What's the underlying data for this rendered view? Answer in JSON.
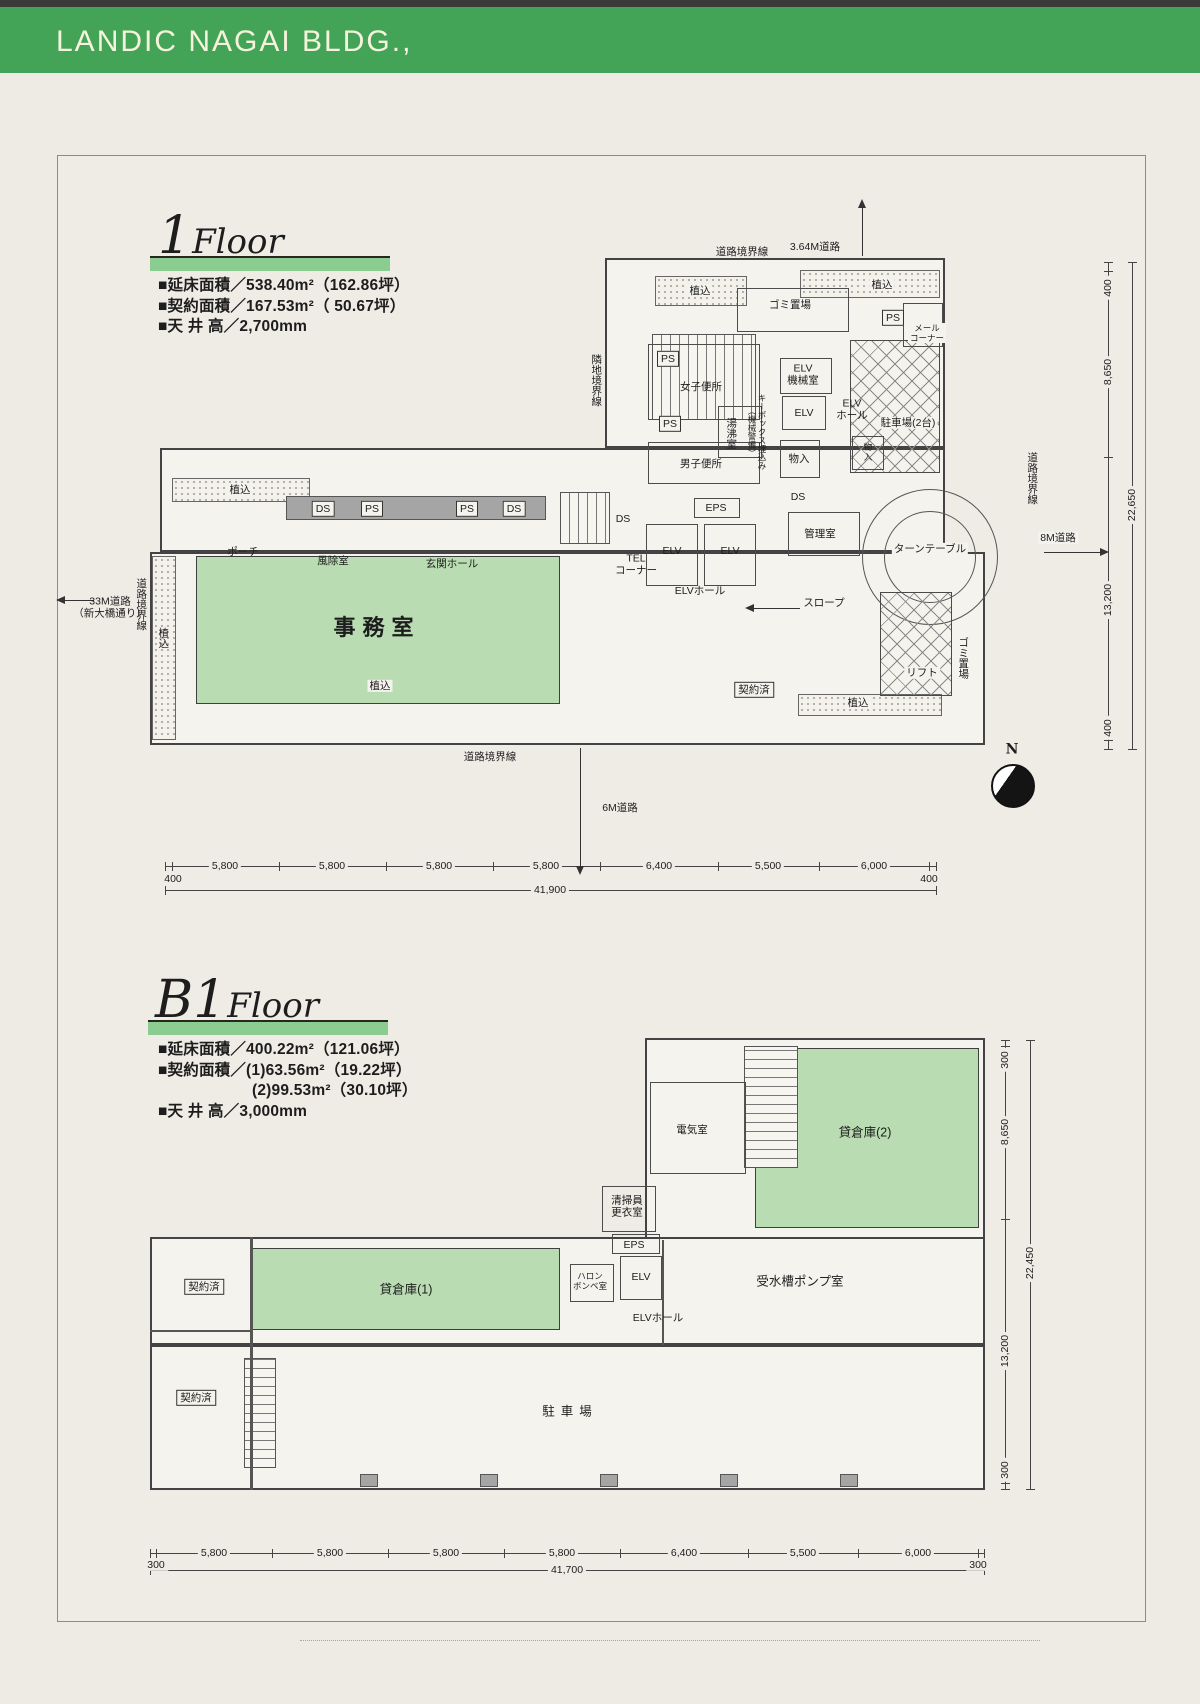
{
  "header": {
    "title": "LANDIC NAGAI BLDG.,"
  },
  "colors": {
    "header_green": "#43a457",
    "title_bar_green": "#8bcd90",
    "room_green": "#b9dcb3"
  },
  "floor1": {
    "title_num": "1",
    "title_word": "Floor",
    "specs": [
      "■延床面積／538.40m²（162.86坪）",
      "■契約面積／167.53m²（ 50.67坪）",
      "■天 井 高／2,700mm"
    ],
    "labels": [
      {
        "t": "3.64M道路",
        "x": 815,
        "y": 247,
        "c": "xs"
      },
      {
        "t": "道路境界線",
        "x": 742,
        "y": 252,
        "c": "xs"
      },
      {
        "t": "植込",
        "x": 700,
        "y": 291,
        "c": "xs chip"
      },
      {
        "t": "植込",
        "x": 882,
        "y": 285,
        "c": "xs chip"
      },
      {
        "t": "ゴミ置場",
        "x": 790,
        "y": 305,
        "c": "xs chip"
      },
      {
        "t": "PS",
        "x": 893,
        "y": 318,
        "c": "xs box"
      },
      {
        "t": "メール\nコーナー",
        "x": 927,
        "y": 333,
        "c": "xxs chip"
      },
      {
        "t": "隣地境界線",
        "x": 596,
        "y": 380,
        "c": "v xs"
      },
      {
        "t": "PS",
        "x": 668,
        "y": 359,
        "c": "xs box"
      },
      {
        "t": "女子便所",
        "x": 701,
        "y": 387,
        "c": "xs"
      },
      {
        "t": "湯沸室",
        "x": 731,
        "y": 433,
        "c": "v xs"
      },
      {
        "t": "キーボックス埋込み\n（機械警備）",
        "x": 757,
        "y": 432,
        "c": "v xxs"
      },
      {
        "t": "PS",
        "x": 670,
        "y": 424,
        "c": "xs box"
      },
      {
        "t": "男子便所",
        "x": 701,
        "y": 464,
        "c": "xs"
      },
      {
        "t": "ELV\n機械室",
        "x": 803,
        "y": 375,
        "c": "xs"
      },
      {
        "t": "ELV",
        "x": 804,
        "y": 413,
        "c": "xs"
      },
      {
        "t": "ELV\nホール",
        "x": 852,
        "y": 410,
        "c": "xs"
      },
      {
        "t": "物入",
        "x": 799,
        "y": 459,
        "c": "xs"
      },
      {
        "t": "物\n入",
        "x": 868,
        "y": 452,
        "c": "xxs"
      },
      {
        "t": "駐車場(2台)",
        "x": 908,
        "y": 423,
        "c": "xs chip"
      },
      {
        "t": "DS",
        "x": 798,
        "y": 497,
        "c": "xs"
      },
      {
        "t": "管理室",
        "x": 820,
        "y": 534,
        "c": "xs"
      },
      {
        "t": "ターンテーブル",
        "x": 930,
        "y": 549,
        "c": "xs chip"
      },
      {
        "t": "スロープ",
        "x": 824,
        "y": 603,
        "c": "xs chip"
      },
      {
        "t": "DS",
        "x": 323,
        "y": 509,
        "c": "xs box"
      },
      {
        "t": "PS",
        "x": 372,
        "y": 509,
        "c": "xs box"
      },
      {
        "t": "PS",
        "x": 467,
        "y": 509,
        "c": "xs box"
      },
      {
        "t": "DS",
        "x": 514,
        "y": 509,
        "c": "xs box"
      },
      {
        "t": "植込",
        "x": 240,
        "y": 490,
        "c": "xs chip"
      },
      {
        "t": "ポーチ",
        "x": 243,
        "y": 552,
        "c": "xs"
      },
      {
        "t": "風除室",
        "x": 333,
        "y": 561,
        "c": "xs"
      },
      {
        "t": "玄関ホール",
        "x": 452,
        "y": 564,
        "c": "xs"
      },
      {
        "t": "DS",
        "x": 623,
        "y": 519,
        "c": "xs"
      },
      {
        "t": "TEL\nコーナー",
        "x": 636,
        "y": 565,
        "c": "xs"
      },
      {
        "t": "EPS",
        "x": 716,
        "y": 508,
        "c": "xs"
      },
      {
        "t": "ELV",
        "x": 672,
        "y": 551,
        "c": "xs"
      },
      {
        "t": "ELV",
        "x": 730,
        "y": 551,
        "c": "xs"
      },
      {
        "t": "ELVホール",
        "x": 700,
        "y": 591,
        "c": "xs"
      },
      {
        "t": "事務室",
        "x": 377,
        "y": 628,
        "c": "big"
      },
      {
        "t": "契約済",
        "x": 754,
        "y": 690,
        "c": "xs box"
      },
      {
        "t": "リフト",
        "x": 922,
        "y": 673,
        "c": "xs chip"
      },
      {
        "t": "ゴミ置場",
        "x": 963,
        "y": 658,
        "c": "v xs"
      },
      {
        "t": "植込",
        "x": 163,
        "y": 638,
        "c": "v xs"
      },
      {
        "t": "道路境界線",
        "x": 141,
        "y": 604,
        "c": "v xs"
      },
      {
        "t": "33M道路\n（新大橋通り）",
        "x": 110,
        "y": 608,
        "c": "xs"
      },
      {
        "t": "植込",
        "x": 380,
        "y": 686,
        "c": "xs chip"
      },
      {
        "t": "植込",
        "x": 858,
        "y": 703,
        "c": "xs chip"
      },
      {
        "t": "道路境界線",
        "x": 490,
        "y": 757,
        "c": "xs"
      },
      {
        "t": "6M道路",
        "x": 620,
        "y": 808,
        "c": "xs"
      },
      {
        "t": "道路境界線",
        "x": 1032,
        "y": 478,
        "c": "v xs"
      },
      {
        "t": "8M道路",
        "x": 1058,
        "y": 538,
        "c": "xs chip"
      },
      {
        "t": "N",
        "x": 1012,
        "y": 750,
        "c": "n"
      },
      {
        "t": "5,800",
        "x": 225,
        "y": 866,
        "c": "dim"
      },
      {
        "t": "5,800",
        "x": 332,
        "y": 866,
        "c": "dim"
      },
      {
        "t": "5,800",
        "x": 439,
        "y": 866,
        "c": "dim"
      },
      {
        "t": "5,800",
        "x": 546,
        "y": 866,
        "c": "dim"
      },
      {
        "t": "6,400",
        "x": 659,
        "y": 866,
        "c": "dim"
      },
      {
        "t": "5,500",
        "x": 768,
        "y": 866,
        "c": "dim"
      },
      {
        "t": "6,000",
        "x": 874,
        "y": 866,
        "c": "dim"
      },
      {
        "t": "400",
        "x": 173,
        "y": 879,
        "c": "dim"
      },
      {
        "t": "400",
        "x": 929,
        "y": 879,
        "c": "dim"
      },
      {
        "t": "41,900",
        "x": 550,
        "y": 890,
        "c": "dim chip"
      },
      {
        "t": "400",
        "x": 1108,
        "y": 288,
        "c": "dimv"
      },
      {
        "t": "8,650",
        "x": 1108,
        "y": 372,
        "c": "dimv"
      },
      {
        "t": "13,200",
        "x": 1108,
        "y": 600,
        "c": "dimv"
      },
      {
        "t": "400",
        "x": 1108,
        "y": 728,
        "c": "dimv"
      },
      {
        "t": "22,650",
        "x": 1132,
        "y": 505,
        "c": "dimv"
      }
    ]
  },
  "b1": {
    "title_num": "B1",
    "title_word": "Floor",
    "specs": [
      "■延床面積／400.22m²（121.06坪）",
      "■契約面積／(1)63.56m²（19.22坪）",
      "(2)99.53m²（30.10坪）",
      "■天 井 高／3,000mm"
    ],
    "labels": [
      {
        "t": "電気室",
        "x": 692,
        "y": 1130,
        "c": "xs"
      },
      {
        "t": "貸倉庫(2)",
        "x": 865,
        "y": 1133,
        "c": "s"
      },
      {
        "t": "清掃員\n更衣室",
        "x": 627,
        "y": 1207,
        "c": "xs"
      },
      {
        "t": "EPS",
        "x": 634,
        "y": 1245,
        "c": "xs"
      },
      {
        "t": "ハロン\nボンベ室",
        "x": 590,
        "y": 1281,
        "c": "xxs"
      },
      {
        "t": "ELV",
        "x": 641,
        "y": 1277,
        "c": "xs"
      },
      {
        "t": "ELVホール",
        "x": 658,
        "y": 1318,
        "c": "xs"
      },
      {
        "t": "受水槽ポンプ室",
        "x": 800,
        "y": 1282,
        "c": "s"
      },
      {
        "t": "貸倉庫(1)",
        "x": 406,
        "y": 1290,
        "c": "s"
      },
      {
        "t": "契約済",
        "x": 204,
        "y": 1287,
        "c": "xs box"
      },
      {
        "t": "契約済",
        "x": 196,
        "y": 1398,
        "c": "xs box"
      },
      {
        "t": "駐車場",
        "x": 570,
        "y": 1412,
        "c": "s sp"
      },
      {
        "t": "5,800",
        "x": 214,
        "y": 1553,
        "c": "dim"
      },
      {
        "t": "5,800",
        "x": 330,
        "y": 1553,
        "c": "dim"
      },
      {
        "t": "5,800",
        "x": 446,
        "y": 1553,
        "c": "dim"
      },
      {
        "t": "5,800",
        "x": 562,
        "y": 1553,
        "c": "dim"
      },
      {
        "t": "6,400",
        "x": 684,
        "y": 1553,
        "c": "dim"
      },
      {
        "t": "5,500",
        "x": 803,
        "y": 1553,
        "c": "dim"
      },
      {
        "t": "6,000",
        "x": 918,
        "y": 1553,
        "c": "dim"
      },
      {
        "t": "300",
        "x": 156,
        "y": 1565,
        "c": "dim"
      },
      {
        "t": "300",
        "x": 978,
        "y": 1565,
        "c": "dim"
      },
      {
        "t": "41,700",
        "x": 567,
        "y": 1570,
        "c": "dim chip"
      },
      {
        "t": "300",
        "x": 1005,
        "y": 1060,
        "c": "dimv"
      },
      {
        "t": "8,650",
        "x": 1005,
        "y": 1132,
        "c": "dimv"
      },
      {
        "t": "13,200",
        "x": 1005,
        "y": 1351,
        "c": "dimv"
      },
      {
        "t": "300",
        "x": 1005,
        "y": 1470,
        "c": "dimv"
      },
      {
        "t": "22,450",
        "x": 1030,
        "y": 1263,
        "c": "dimv"
      }
    ]
  }
}
